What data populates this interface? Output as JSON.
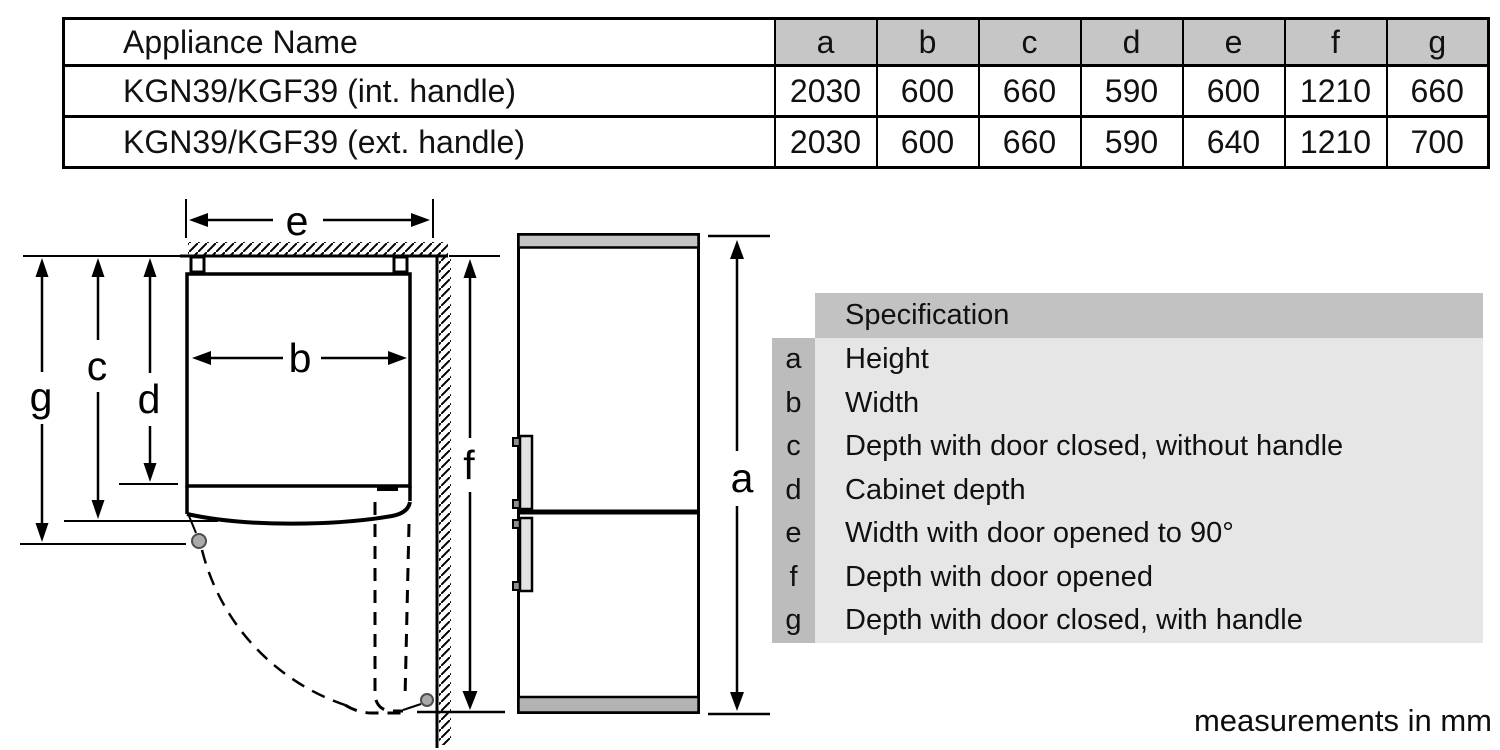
{
  "dimension_table": {
    "columns": [
      "Appliance Name",
      "a",
      "b",
      "c",
      "d",
      "e",
      "f",
      "g"
    ],
    "rows": [
      {
        "name": "KGN39/KGF39 (int. handle)",
        "values": [
          "2030",
          "600",
          "660",
          "590",
          "600",
          "1210",
          "660"
        ]
      },
      {
        "name": "KGN39/KGF39 (ext. handle)",
        "values": [
          "2030",
          "600",
          "660",
          "590",
          "640",
          "1210",
          "700"
        ]
      }
    ]
  },
  "spec_table": {
    "header": "Specification",
    "rows": [
      {
        "key": "a",
        "label": "Height"
      },
      {
        "key": "b",
        "label": "Width"
      },
      {
        "key": "c",
        "label": "Depth with door closed, without handle"
      },
      {
        "key": "d",
        "label": "Cabinet depth"
      },
      {
        "key": "e",
        "label": "Width with door opened to 90°"
      },
      {
        "key": "f",
        "label": "Depth with door opened"
      },
      {
        "key": "g",
        "label": "Depth with door closed, with handle"
      }
    ]
  },
  "diagram": {
    "labels": {
      "a": "a",
      "b": "b",
      "c": "c",
      "d": "d",
      "e": "e",
      "f": "f",
      "g": "g"
    }
  },
  "footer_note": "measurements in mm",
  "colors": {
    "table_header_bg": "#c6c6c6",
    "spec_header_bg": "#c2c2c2",
    "spec_key_col_bg": "#bcbcbc",
    "spec_row_bg": "#e6e6e6",
    "line_color": "#000000",
    "fridge_top_strip": "#c4c4c4",
    "fridge_plinth": "#b3b3b3",
    "handle_gray": "#e3e3e3",
    "hinge_dot_gray": "#aaaaaa"
  }
}
